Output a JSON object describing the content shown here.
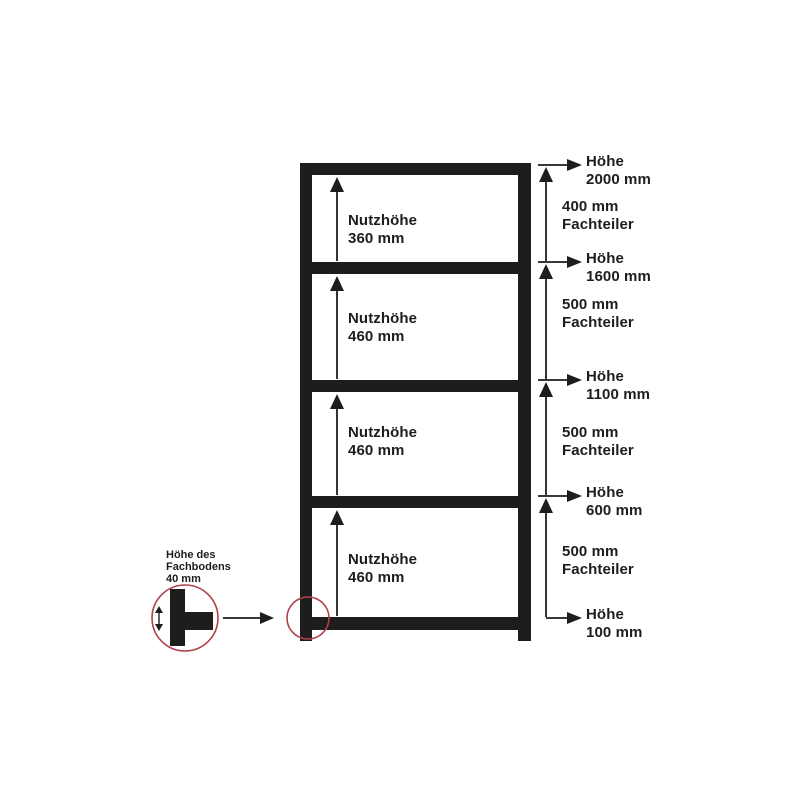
{
  "diagram": {
    "description": "Shelving unit height dimension drawing",
    "colors": {
      "structure": "#1d1d1b",
      "text": "#1d1d1b",
      "highlight_red": "#b2404a",
      "background": "#ffffff"
    },
    "compartments": [
      {
        "label_line1": "Nutzhöhe",
        "label_line2": "360 mm"
      },
      {
        "label_line1": "Nutzhöhe",
        "label_line2": "460 mm"
      },
      {
        "label_line1": "Nutzhöhe",
        "label_line2": "460 mm"
      },
      {
        "label_line1": "Nutzhöhe",
        "label_line2": "460 mm"
      }
    ],
    "height_labels": [
      {
        "line1": "Höhe",
        "line2": "2000 mm"
      },
      {
        "line1": "Höhe",
        "line2": "1600 mm"
      },
      {
        "line1": "Höhe",
        "line2": "1100 mm"
      },
      {
        "line1": "Höhe",
        "line2": "600 mm"
      },
      {
        "line1": "Höhe",
        "line2": "100 mm"
      }
    ],
    "divider_labels": [
      {
        "line1": "400 mm",
        "line2": "Fachteiler"
      },
      {
        "line1": "500 mm",
        "line2": "Fachteiler"
      },
      {
        "line1": "500 mm",
        "line2": "Fachteiler"
      },
      {
        "line1": "500 mm",
        "line2": "Fachteiler"
      }
    ],
    "detail": {
      "line1": "Höhe des",
      "line2": "Fachbodens",
      "line3": "40 mm"
    }
  }
}
